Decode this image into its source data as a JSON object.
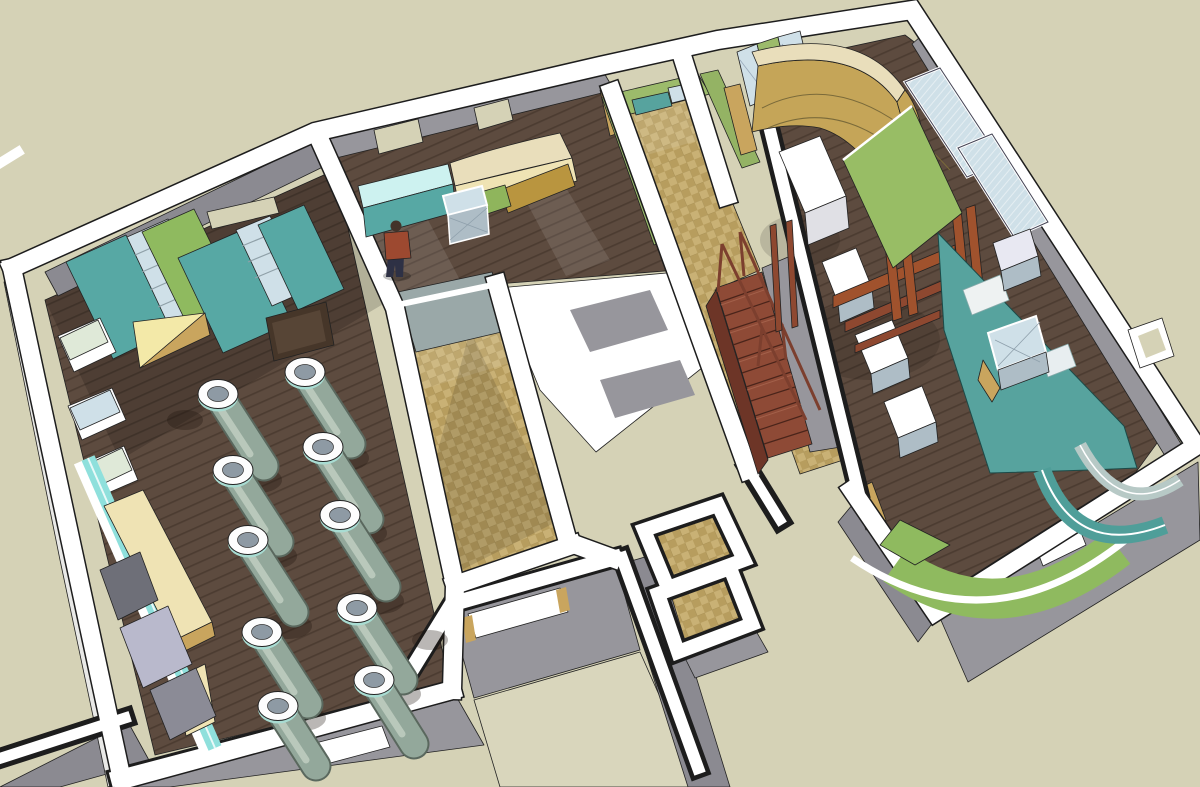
{
  "scene": {
    "type": "3d-architectural-cutaway-floorplan",
    "style": "sketchup-axonometric-render",
    "rooms": [
      {
        "id": "exhibit-hall",
        "floor": "dark-wood",
        "objects": [
          "wardrobe-partitions",
          "glass-display-prisms",
          "yellow-wedge-bench",
          "cyan-ramp",
          "display-cylinders",
          "storage-boxes",
          "dark-table"
        ]
      },
      {
        "id": "reception-room",
        "floor": "dark-wood",
        "objects": [
          "long-counter",
          "glass-display-cube",
          "person-figure",
          "window-openings"
        ]
      },
      {
        "id": "tiled-room",
        "floor": "tile",
        "objects": [
          "blue-gray-mat"
        ]
      },
      {
        "id": "corridor",
        "floor": "tile",
        "objects": [
          "green-walls",
          "teal-glass-panels",
          "wood-staircase",
          "handrails"
        ]
      },
      {
        "id": "curved-gallery",
        "floor": "dark-wood",
        "objects": [
          "curved-ochre-wall",
          "glass-shelving",
          "green-door-panels"
        ]
      },
      {
        "id": "right-wing",
        "floor": "dark-wood",
        "objects": [
          "white-pedestals",
          "red-wood-frame",
          "green-freestanding-panel",
          "teal-feature-wall",
          "wall-display-boxes",
          "leaning-window-panels",
          "curved-reception-desk",
          "green-floor-arc"
        ]
      },
      {
        "id": "annex-rooms",
        "floor": "tile",
        "objects": [
          "slot-windows"
        ]
      }
    ],
    "counts": {
      "display_cylinders": 10,
      "wall_pedestals": 4,
      "glass_display_prisms": 3,
      "stair_steps": 12,
      "window_openings_north_wall": 2
    }
  },
  "palette": {
    "ground": "#d5d2b6",
    "wallTop": "#ffffff",
    "wallFace": "#97969c",
    "wallFaceDark": "#8b8a91",
    "wallFaceLight": "#d8d8da",
    "woodBase": "#5d4b3f",
    "woodLine": "#4c3c31",
    "tileBase": "#c9b175",
    "tileAlt": "#b79d5e",
    "teal": "#57a8a4",
    "tealWall": "#57a39e",
    "green": "#8fba5f",
    "greenWall": "#9cbb6b",
    "greenPanel": "#98bd65",
    "ochre": "#c5a558",
    "creamTop": "#e9debb",
    "cream": "#efe3b4",
    "yellow": "#f3e9a8",
    "cyan": "#8fe0dc",
    "cyanLight": "#cdf2f0",
    "glass": "#cfe0e8",
    "glassGreen": "#dfe9d8",
    "steel": "#aebdc6",
    "matBlue": "#9aa8a8",
    "stairRed": "#8e4a36",
    "stairRedDark": "#6d3527",
    "railRed": "#7c3f2e",
    "redWood": "#a0522d",
    "lavender": "#b9b9cc",
    "grayBox": "#6e6f78",
    "grayBox2": "#8b8b96",
    "tanDoor": "#c9a55e",
    "beigeInner": "#d9d6bc",
    "oliveCounter": "#b9953f",
    "greenCounter": "#8fb55c",
    "personShirt": "#9d4930",
    "personPants": "#2e3145",
    "personHair": "#43342a",
    "cylBody": "#93a89b",
    "cylBodyDark": "#5a685e",
    "cylHighlight": "#b9c8bb",
    "cylRim": "#a8dcd2",
    "cylHole": "#8e9aa4"
  }
}
